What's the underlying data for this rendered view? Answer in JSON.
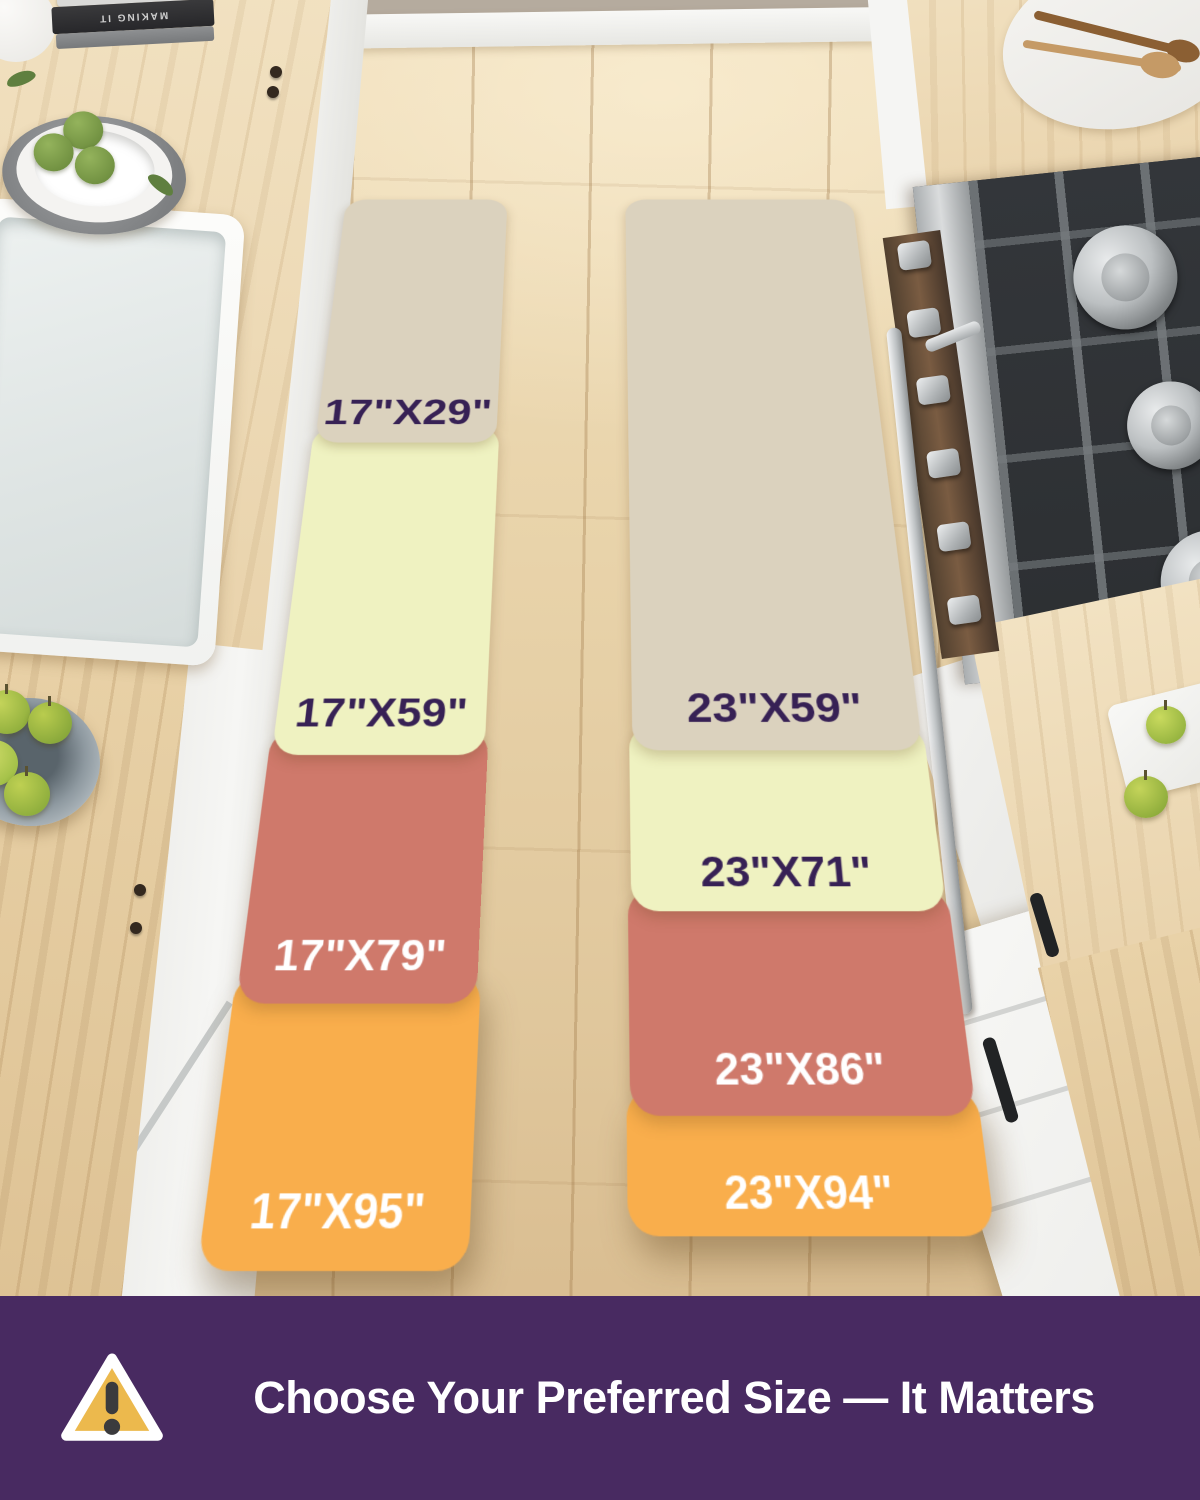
{
  "size_chart": {
    "left": [
      {
        "label": "17\"X29\"",
        "color": "#DBD2BE",
        "label_color": "#372155"
      },
      {
        "label": "17\"X59\"",
        "color": "#EFF2C1",
        "label_color": "#372155"
      },
      {
        "label": "17\"X79\"",
        "color": "#CF796B",
        "label_color": "#FFFFFF"
      },
      {
        "label": "17\"X95\"",
        "color": "#F9AE4C",
        "label_color": "#FFFFFF"
      }
    ],
    "right": [
      {
        "label": "23\"X59\"",
        "color": "#DBD2BE",
        "label_color": "#372155"
      },
      {
        "label": "23\"X71\"",
        "color": "#EFF2C1",
        "label_color": "#372155"
      },
      {
        "label": "23\"X86\"",
        "color": "#CF796B",
        "label_color": "#FFFFFF"
      },
      {
        "label": "23\"X94\"",
        "color": "#F9AE4C",
        "label_color": "#FFFFFF"
      }
    ]
  },
  "banner": {
    "text": "Choose Your Preferred Size — It Matters",
    "background": "#482A61",
    "icon": "warning-triangle-icon",
    "icon_fill": "#ECB94D",
    "icon_mark_color": "#3B3B3D"
  },
  "scene": {
    "book_title": "MAKING IT"
  }
}
